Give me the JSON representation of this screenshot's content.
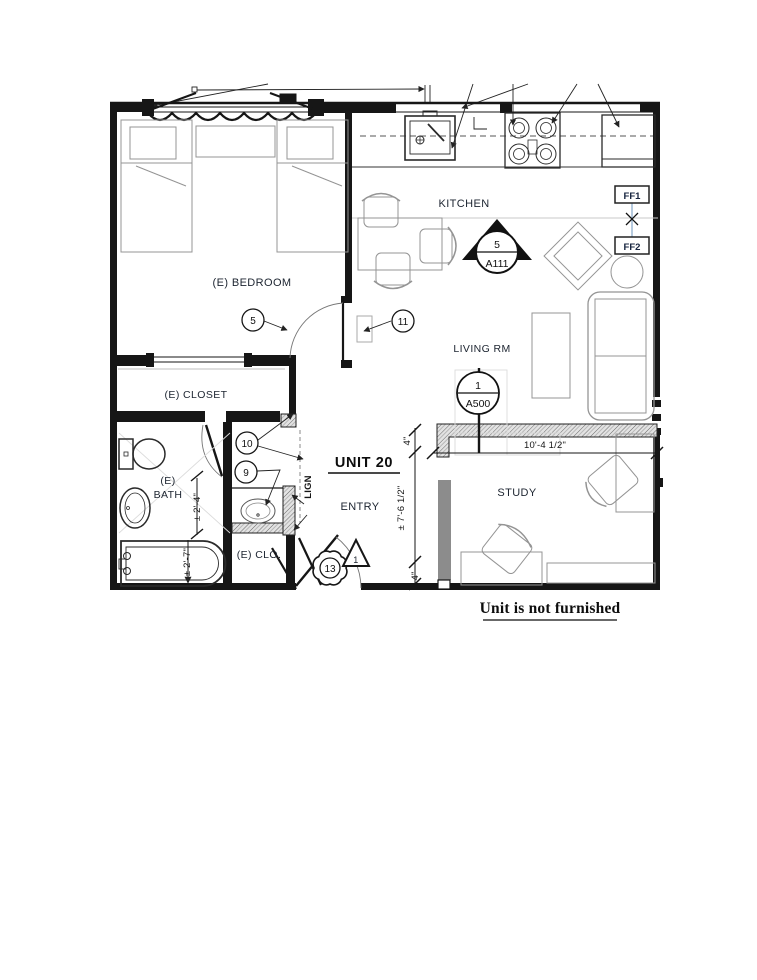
{
  "plan": {
    "unit_label": "UNIT 20",
    "note": "Unit is not furnished",
    "rooms": {
      "kitchen": "KITCHEN",
      "bedroom": "(E) BEDROOM",
      "closet": "(E) CLOSET",
      "bath_line1": "(E)",
      "bath_line2": "BATH",
      "clo": "(E) CLO.",
      "entry": "ENTRY",
      "living": "LIVING RM",
      "study": "STUDY"
    },
    "keynotes": {
      "n5": "5",
      "n9": "9",
      "n10": "10",
      "n11": "11",
      "n13": "13",
      "delta1": "1"
    },
    "symbols": {
      "section_number": "5",
      "section_sheet": "A111",
      "detail_number": "1",
      "detail_sheet": "A500",
      "ff1": "FF1",
      "ff2": "FF2"
    },
    "dims": {
      "living_width": "10'-4 1/2\"",
      "entry_depth": "± 7'-6 1/2\"",
      "offset_top": "4\"",
      "offset_bottom": "4\"",
      "bath_width": "± 2'-4\"",
      "tub_width": "± 2'-7\"",
      "align_note": "LIGN"
    }
  },
  "colors": {
    "line": "#1a1a1a",
    "label": "#1c2430",
    "furniture": "#949494",
    "ff_connector": "#9db8d2",
    "wall_gray": "#8c8c8c"
  }
}
